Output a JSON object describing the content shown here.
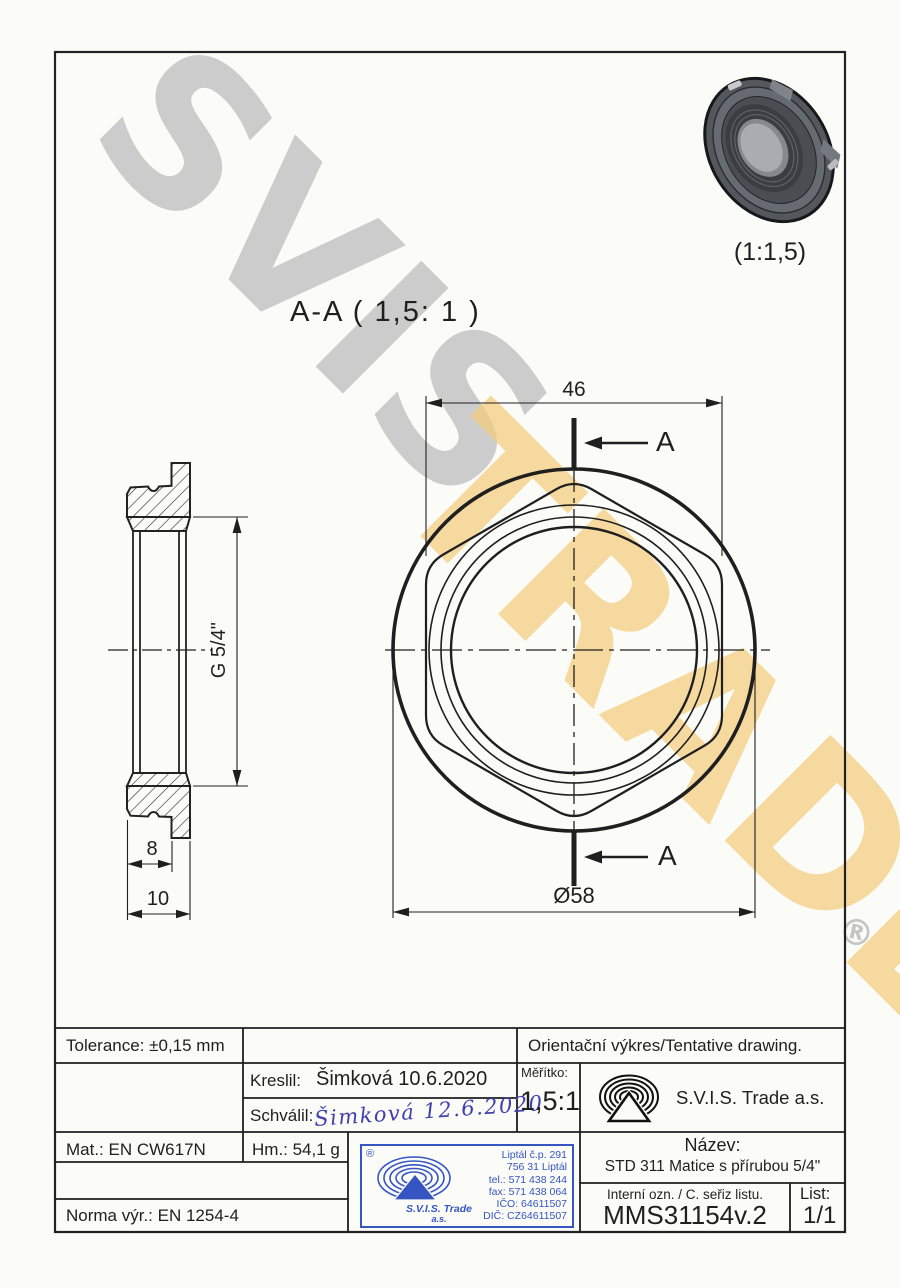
{
  "drawing": {
    "section_view_title": "A-A ( 1,5: 1 )",
    "iso_view_scale": "(1:1,5)",
    "dim_across_flats": "46",
    "dim_outer_diameter": "Ø58",
    "dim_thread": "G 5/4\"",
    "dim_collar": "8",
    "dim_total": "10",
    "section_marker_top": "A",
    "section_marker_bottom": "A"
  },
  "watermark": {
    "word_gray": "SVIS",
    "word_yellow": "TRADE",
    "registered_mark": "®"
  },
  "titleblock": {
    "tolerance": "Tolerance: ±0,15 mm",
    "tentative_note": "Orientační výkres/Tentative drawing.",
    "drawn_label": "Kreslil:",
    "drawn_value": "Šimková 10.6.2020",
    "approved_label": "Schválil:",
    "approved_signature": "Šimková 12.6.2020",
    "scale_label": "Měřítko:",
    "scale_value": "1,5:1",
    "company_name": "S.V.I.S. Trade a.s.",
    "material": "Mat.: EN CW617N",
    "weight": "Hm.: 54,1 g",
    "standard": "Norma výr.: EN 1254-4",
    "title_label": "Název:",
    "title_value": "STD 311 Matice s přírubou 5/4\"",
    "internal_code_label": "Interní ozn. / C. seřiz listu.",
    "internal_code_value": "MMS31154v.2",
    "sheet_label": "List:",
    "sheet_value": "1/1"
  },
  "stamp": {
    "registered_mark": "®",
    "company_line1": "S.V.I.S. Trade",
    "company_line2": "a.s.",
    "address_line1": "Liptál č.p. 291",
    "address_line2": "756 31 Liptál",
    "phone": "tel.: 571 438 244",
    "fax": "fax: 571 438 064",
    "company_id": "IČO: 64611507",
    "vat_id": "DIČ: CZ64611507"
  },
  "colors": {
    "line": "#1f1f1f",
    "stamp_blue": "#3555c2",
    "signature_blue": "#3f3fae",
    "watermark_gray": "#c9c9c9",
    "watermark_yellow": "#f5cd7d"
  }
}
